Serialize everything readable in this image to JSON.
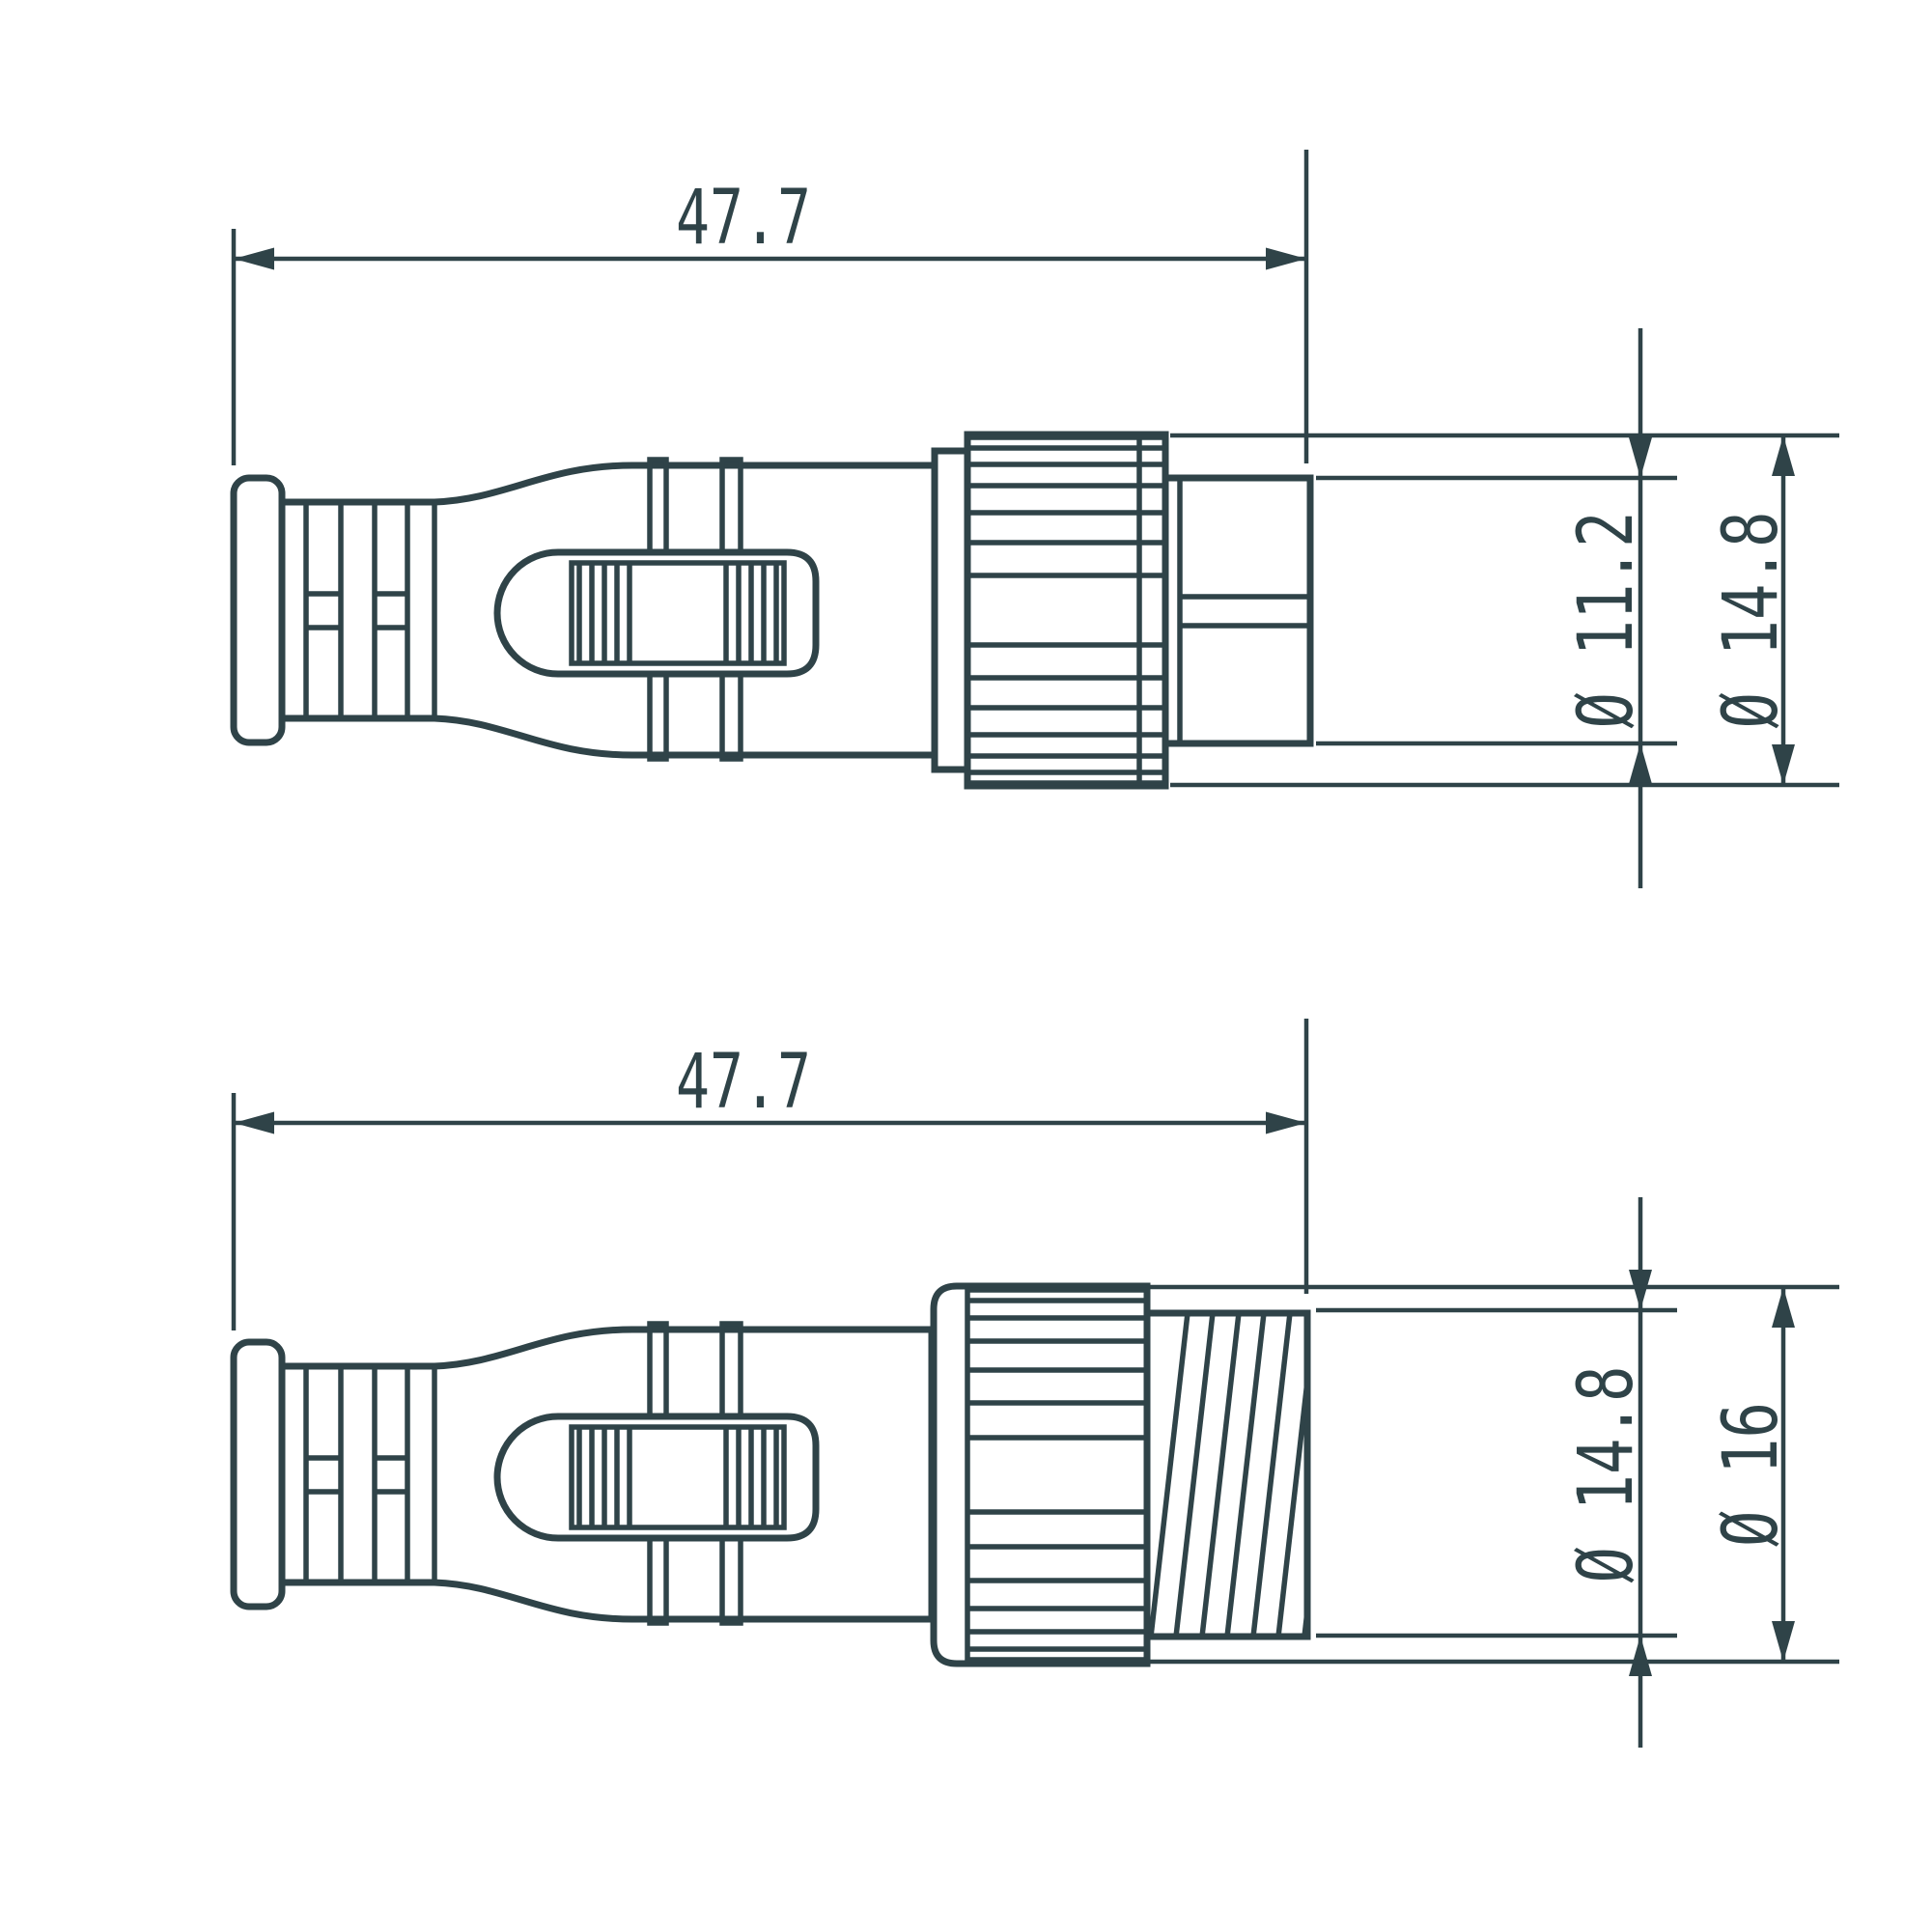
{
  "palette": {
    "line": "#2f4348",
    "background": "#ffffff"
  },
  "views": {
    "top": {
      "name": "connector plug side view",
      "length": "47.7",
      "dia_inner": "Ø 11.2",
      "dia_outer": "Ø 14.8"
    },
    "bottom": {
      "name": "connector socket side view",
      "length": "47.7",
      "dia_inner": "Ø 14.8",
      "dia_outer": "Ø 16"
    }
  }
}
